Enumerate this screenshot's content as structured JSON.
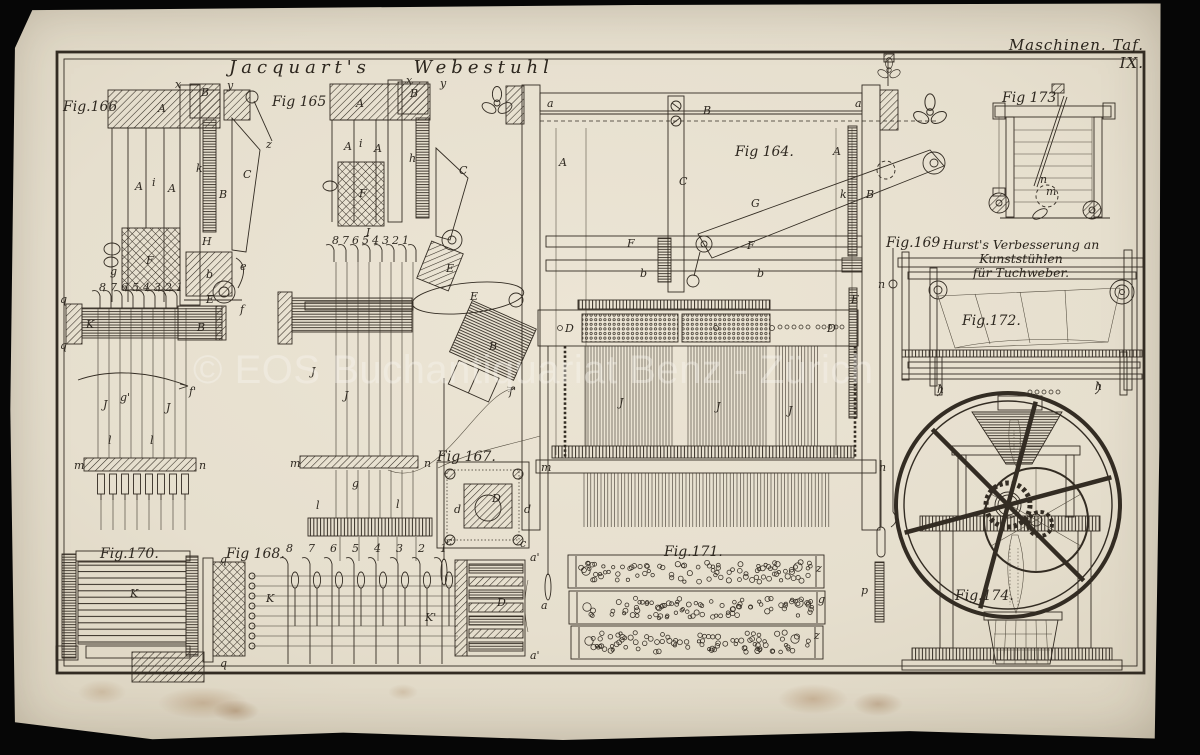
{
  "plate": {
    "header": "Maschinen. Taf. IX.",
    "title": "Jacquart's Webestuhl",
    "watermark": "© EOS Buchantiquariat Benz - Zürich",
    "hurst_line1": "Hurst's Verbesserung an Kunststühlen",
    "hurst_line2": "für Tuchweber.",
    "colors": {
      "paper": "#e6dfcf",
      "ink": "#332c23",
      "backdrop": "#060606",
      "watermark": "rgba(247,245,239,0.40)"
    }
  },
  "figures": [
    {
      "id": "fig166",
      "label": "Fig.166",
      "label_pos": [
        63,
        111
      ],
      "letters": [
        [
          "A",
          158,
          112
        ],
        [
          "x",
          175,
          88,
          9
        ],
        [
          "B",
          201,
          96,
          10
        ],
        [
          "y",
          227,
          89,
          9
        ],
        [
          "A",
          135,
          190
        ],
        [
          "i",
          152,
          186,
          9
        ],
        [
          "A",
          168,
          192
        ],
        [
          "k",
          196,
          172,
          9
        ],
        [
          "B",
          219,
          198
        ],
        [
          "C",
          243,
          178
        ],
        [
          "z",
          266,
          148,
          9
        ],
        [
          "F",
          146,
          264
        ],
        [
          "g",
          110,
          275,
          9
        ],
        [
          "H",
          202,
          245,
          9
        ],
        [
          "b",
          206,
          278
        ],
        [
          "e",
          240,
          270,
          9
        ],
        [
          "E",
          206,
          303
        ],
        [
          "K",
          86,
          328
        ],
        [
          "B",
          197,
          331
        ],
        [
          "q",
          60,
          303,
          9
        ],
        [
          "q",
          60,
          349,
          9
        ],
        [
          "f",
          240,
          313,
          9
        ],
        [
          "f'",
          189,
          395,
          9
        ],
        [
          "m",
          74,
          469,
          9
        ],
        [
          "n",
          199,
          469,
          9
        ],
        [
          "J",
          103,
          408
        ],
        [
          "J",
          166,
          411
        ],
        [
          "g'",
          120,
          401,
          9
        ],
        [
          "l",
          108,
          444,
          9
        ],
        [
          "l",
          150,
          444,
          9
        ],
        [
          "8",
          99,
          291,
          7
        ],
        [
          "7",
          110,
          291,
          7
        ],
        [
          "6",
          121,
          291,
          7
        ],
        [
          "5",
          132,
          291,
          7
        ],
        [
          "4",
          143,
          291,
          7
        ],
        [
          "3",
          154,
          291,
          7
        ],
        [
          "2",
          165,
          291,
          7
        ],
        [
          "1",
          176,
          291,
          7
        ]
      ],
      "linesets": [
        {
          "dir": "v",
          "from": 98,
          "to": 188,
          "pitch": 11,
          "a": 308,
          "b": 458
        },
        {
          "dir": "v",
          "from": 101,
          "to": 185,
          "pitch": 12,
          "a": 499,
          "b": 530
        }
      ]
    },
    {
      "id": "fig165",
      "label": "Fig 165",
      "label_pos": [
        272,
        106
      ],
      "letters": [
        [
          "A",
          356,
          107
        ],
        [
          "x",
          406,
          84,
          9
        ],
        [
          "B",
          410,
          97,
          10
        ],
        [
          "y",
          440,
          87,
          9
        ],
        [
          "A",
          344,
          150
        ],
        [
          "i",
          359,
          147,
          9
        ],
        [
          "A",
          374,
          152
        ],
        [
          "F",
          359,
          197
        ],
        [
          "h",
          409,
          162,
          9
        ],
        [
          "C",
          459,
          174
        ],
        [
          "I",
          366,
          236
        ],
        [
          "E",
          446,
          272
        ],
        [
          "E",
          470,
          300,
          10
        ],
        [
          "B",
          489,
          350
        ],
        [
          "f'",
          509,
          395,
          9
        ],
        [
          "m",
          290,
          467,
          9
        ],
        [
          "n",
          424,
          467,
          9
        ],
        [
          "J",
          311,
          375
        ],
        [
          "J",
          344,
          399
        ],
        [
          "g",
          352,
          487,
          9
        ],
        [
          "l",
          316,
          509,
          9
        ],
        [
          "l",
          396,
          508,
          9
        ],
        [
          "8",
          332,
          244,
          7
        ],
        [
          "7",
          342,
          244,
          7
        ],
        [
          "6",
          352,
          244,
          7
        ],
        [
          "5",
          362,
          244,
          7
        ],
        [
          "4",
          372,
          244,
          7
        ],
        [
          "3",
          382,
          244,
          7
        ],
        [
          "2",
          392,
          244,
          7
        ],
        [
          "1",
          402,
          244,
          7
        ]
      ],
      "linesets": [
        {
          "dir": "v",
          "from": 336,
          "to": 420,
          "pitch": 11,
          "a": 262,
          "b": 456
        },
        {
          "dir": "v",
          "from": 336,
          "to": 420,
          "pitch": 11,
          "a": 470,
          "b": 518
        },
        {
          "dir": "v",
          "from": 340,
          "to": 418,
          "pitch": 19,
          "a": 537,
          "b": 561
        }
      ]
    },
    {
      "id": "fig164",
      "label": "Fig 164.",
      "label_pos": [
        735,
        156
      ],
      "letters": [
        [
          "a",
          547,
          107,
          10
        ],
        [
          "a",
          855,
          107,
          10
        ],
        [
          "B",
          703,
          114
        ],
        [
          "A",
          559,
          166
        ],
        [
          "A",
          833,
          155
        ],
        [
          "C",
          679,
          185
        ],
        [
          "G",
          751,
          207
        ],
        [
          "F",
          627,
          247
        ],
        [
          "F",
          747,
          249
        ],
        [
          "b",
          640,
          277,
          10
        ],
        [
          "b",
          757,
          277,
          10
        ],
        [
          "k",
          840,
          198,
          9
        ],
        [
          "B",
          866,
          198
        ],
        [
          "E",
          851,
          303
        ],
        [
          "D",
          565,
          332
        ],
        [
          "D",
          827,
          332
        ],
        [
          "J",
          619,
          406
        ],
        [
          "J",
          716,
          410
        ],
        [
          "J",
          788,
          414
        ],
        [
          "m",
          541,
          471,
          9
        ],
        [
          "n",
          879,
          471,
          9
        ]
      ],
      "linesets": [
        {
          "dir": "v",
          "from": 585,
          "to": 673,
          "pitch": 3,
          "a": 346,
          "b": 446
        },
        {
          "dir": "v",
          "from": 688,
          "to": 768,
          "pitch": 3,
          "a": 346,
          "b": 446
        },
        {
          "dir": "v",
          "from": 776,
          "to": 820,
          "pitch": 3.2,
          "a": 346,
          "b": 446
        },
        {
          "dir": "v",
          "from": 584,
          "to": 830,
          "pitch": 3.4,
          "a": 473,
          "b": 527
        }
      ]
    },
    {
      "id": "fig173",
      "label": "Fig 173",
      "label_pos": [
        1002,
        102
      ],
      "letters": [
        [
          "n",
          1040,
          183,
          8
        ],
        [
          "m",
          1046,
          195,
          8
        ]
      ],
      "linesets": [
        {
          "dir": "h",
          "from": 130,
          "to": 206,
          "pitch": 12,
          "a": 1014,
          "b": 1092
        }
      ]
    },
    {
      "id": "fig169",
      "label": "Fig.169",
      "label_pos": [
        886,
        247
      ],
      "letters": [
        [
          "n",
          878,
          288,
          9
        ],
        [
          "p",
          861,
          594,
          9
        ]
      ]
    },
    {
      "id": "fig172",
      "label": "Fig.172.",
      "label_pos": [
        962,
        325
      ],
      "letters": [
        [
          "h",
          937,
          393,
          8
        ],
        [
          "h",
          1095,
          390,
          8
        ]
      ]
    },
    {
      "id": "fig174",
      "label": "Fig.174.",
      "label_pos": [
        955,
        600
      ],
      "letters": []
    },
    {
      "id": "fig167",
      "label": "Fig 167.",
      "label_pos": [
        437,
        461
      ],
      "letters": [
        [
          "D",
          492,
          502
        ],
        [
          "d",
          454,
          513,
          9
        ],
        [
          "d",
          524,
          513,
          9
        ],
        [
          "c",
          446,
          545,
          8
        ],
        [
          "c",
          520,
          547,
          8
        ]
      ]
    },
    {
      "id": "fig170",
      "label": "Fig.170.",
      "label_pos": [
        100,
        558
      ],
      "letters": [
        [
          "K",
          130,
          597
        ]
      ]
    },
    {
      "id": "fig168",
      "label": "Fig 168.",
      "label_pos": [
        226,
        558
      ],
      "letters": [
        [
          "q",
          220,
          563,
          9
        ],
        [
          "q",
          220,
          667,
          9
        ],
        [
          "K",
          266,
          602
        ],
        [
          "K'",
          425,
          621,
          9
        ],
        [
          "D",
          497,
          606
        ],
        [
          "a'",
          530,
          561,
          9
        ],
        [
          "a'",
          530,
          659,
          9
        ],
        [
          "a",
          541,
          609,
          9
        ],
        [
          "8",
          286,
          552,
          7
        ],
        [
          "7",
          308,
          552,
          7
        ],
        [
          "6",
          330,
          552,
          7
        ],
        [
          "5",
          352,
          552,
          7
        ],
        [
          "4",
          374,
          552,
          7
        ],
        [
          "3",
          396,
          552,
          7
        ],
        [
          "2",
          418,
          552,
          7
        ],
        [
          "1",
          440,
          552,
          7
        ]
      ],
      "linesets": [
        {
          "dir": "h",
          "from": 576,
          "to": 648,
          "pitch": 10,
          "a": 252,
          "b": 458
        }
      ]
    },
    {
      "id": "fig171",
      "label": "Fig.171.",
      "label_pos": [
        664,
        556
      ],
      "letters": [
        [
          "z",
          816,
          572,
          8
        ],
        [
          "g",
          818,
          603,
          8
        ],
        [
          "z",
          814,
          639,
          8
        ]
      ],
      "strips": [
        {
          "x": 578,
          "y": 559,
          "w": 236,
          "h": 26,
          "n": 92,
          "seed": 7,
          "big": [
            [
              586,
              571
            ],
            [
              798,
              567
            ]
          ]
        },
        {
          "x": 579,
          "y": 595,
          "w": 236,
          "h": 26,
          "n": 88,
          "seed": 13,
          "big": [
            [
              587,
              607
            ],
            [
              799,
              603
            ]
          ]
        },
        {
          "x": 581,
          "y": 629,
          "w": 232,
          "h": 26,
          "n": 90,
          "seed": 29,
          "big": [
            [
              589,
              641
            ],
            [
              795,
              639
            ]
          ]
        }
      ]
    }
  ]
}
